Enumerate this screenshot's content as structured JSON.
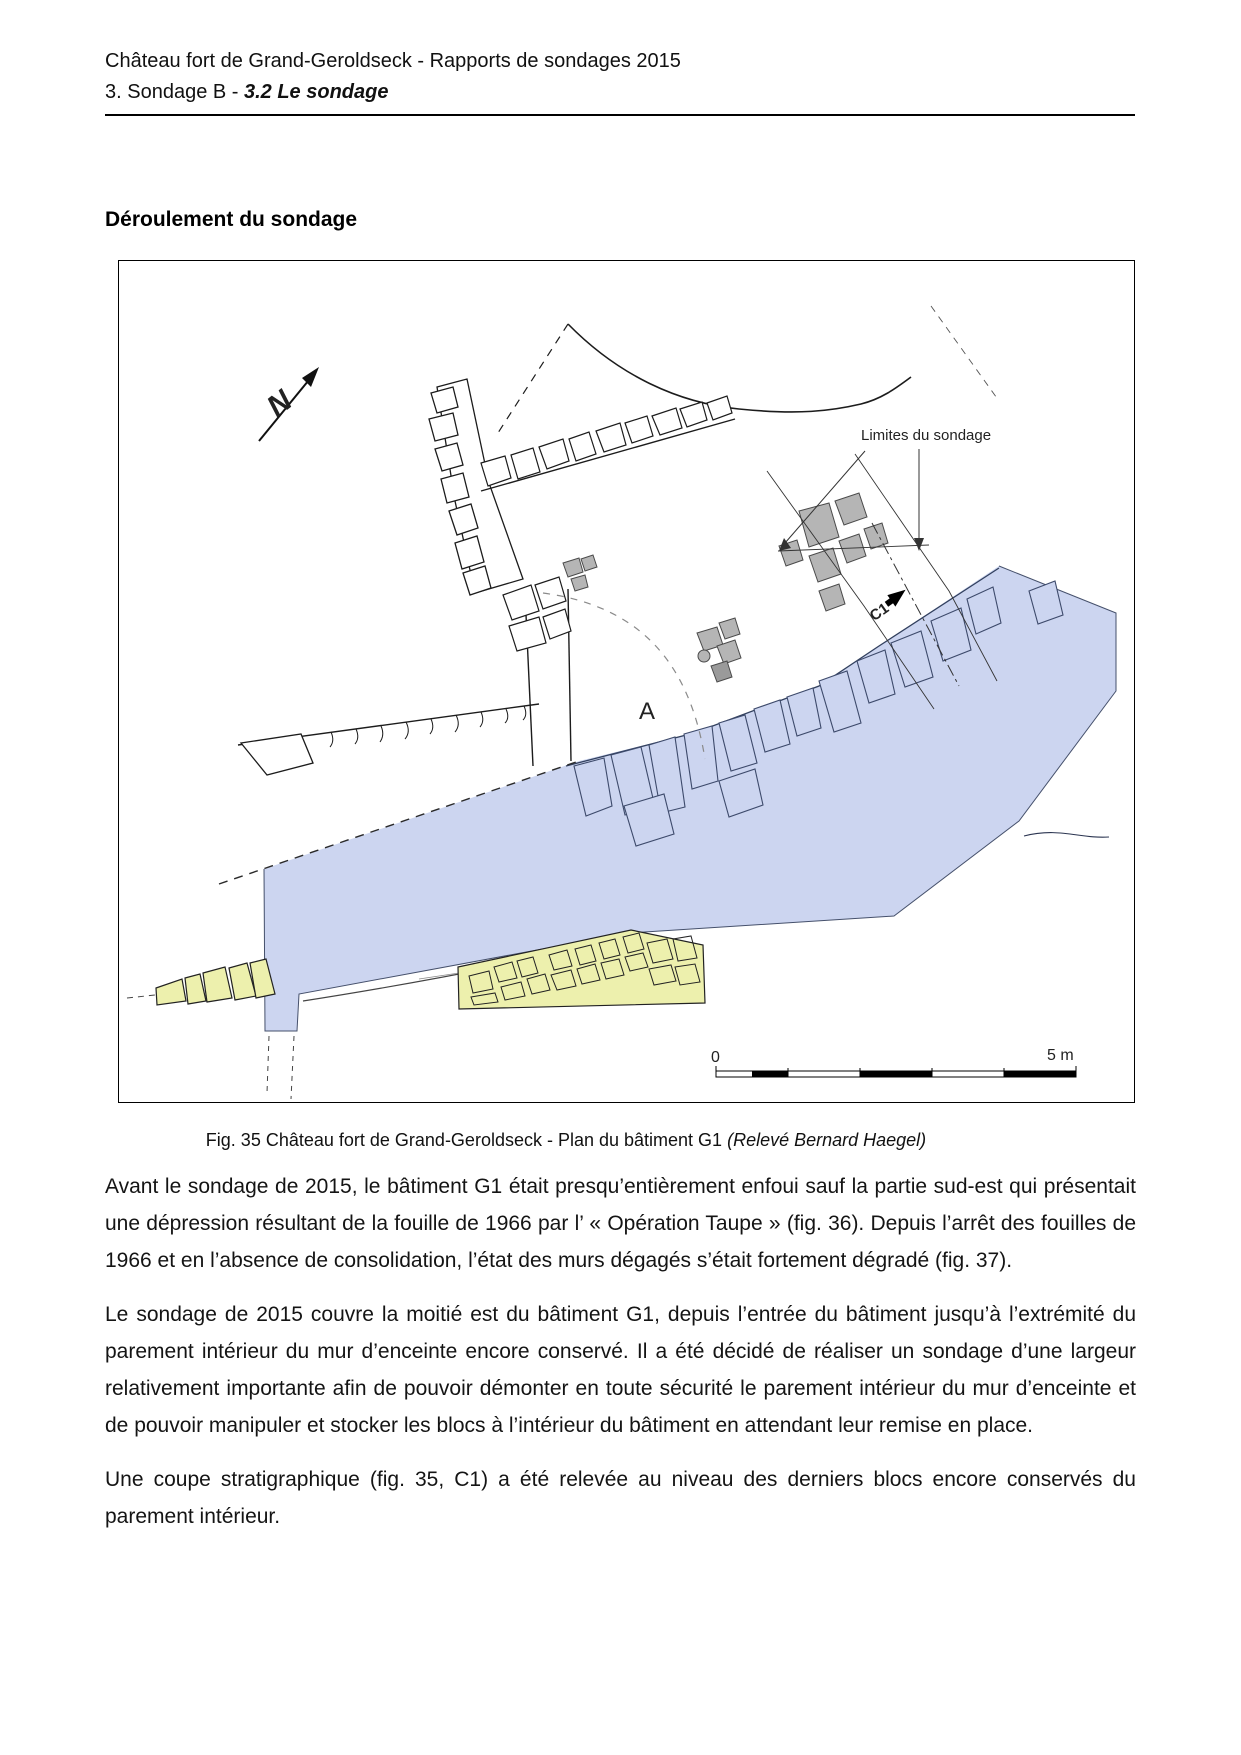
{
  "page": {
    "header_line1": "Château fort de Grand-Geroldseck - Rapports de sondages 2015",
    "header_line2_prefix": "3. Sondage B - ",
    "header_line2_emphasis": "3.2 Le sondage",
    "section_heading": "Déroulement du sondage"
  },
  "figure": {
    "labels": {
      "limites": "Limites du sondage",
      "c1": "C1",
      "zone_a": "A",
      "north": "N",
      "scale_zero": "0",
      "scale_five": "5 m"
    },
    "colors": {
      "sondage_blue": "#ccd5f0",
      "wall_yellow": "#edf0ad",
      "stone_grey": "#b5b5b5"
    },
    "caption_main": "Fig. 35 Château fort de Grand-Geroldseck - Plan du bâtiment G1 ",
    "caption_italic": "(Relevé Bernard Haegel)"
  },
  "paragraphs": [
    "Avant le sondage de 2015, le bâtiment G1 était presqu’entièrement enfoui sauf la partie sud-est qui présentait une dépression résultant de la fouille de 1966 par l’ « Opération Taupe » (fig. 36). Depuis l’arrêt des fouilles de 1966 et en l’absence de consolidation, l’état des murs dégagés s’était fortement dégradé (fig. 37).",
    "Le sondage de 2015 couvre la moitié est du bâtiment G1, depuis l’entrée du bâtiment jusqu’à l’extrémité du parement intérieur du mur d’enceinte encore conservé. Il a été décidé de réaliser un sondage d’une largeur relativement importante afin de pouvoir démonter en toute sécurité le parement intérieur du mur d’enceinte et de pouvoir manipuler et stocker les blocs à l’intérieur du bâtiment en attendant leur remise en place.",
    "Une coupe stratigraphique (fig. 35, C1) a été relevée au niveau des derniers blocs encore conservés du parement intérieur."
  ]
}
